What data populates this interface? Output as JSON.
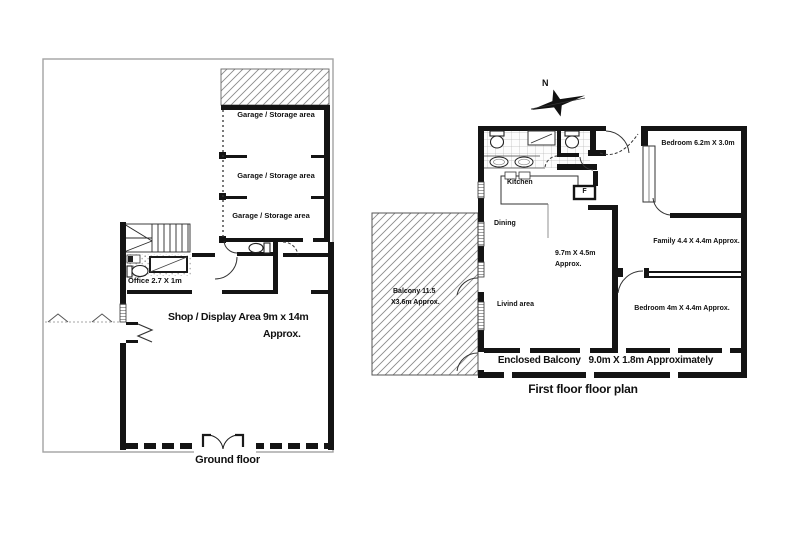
{
  "colors": {
    "ink": "#111111",
    "boundary": "#a3a3a3",
    "hatch": "#8a8a8a"
  },
  "ground_floor": {
    "caption": "Ground floor",
    "garage_labels": [
      "Garage / Storage area",
      "Garage / Storage area",
      "Garage / Storage area"
    ],
    "office_label": "Office 2.7 X 1m",
    "shop_area_label": "Shop / Display Area",
    "shop_area_size": "9m x 14m",
    "shop_area_approx": "Approx."
  },
  "first_floor": {
    "caption": "First floor floor plan",
    "compass_label": "N",
    "kitchen_label": "Kitchen",
    "dining_label": "Dining",
    "living_label": "Livind area",
    "living_size_line1": "9.7m X 4.5m",
    "living_size_line2": "Approx.",
    "fridge_label": "F",
    "bedroom_top_label": "Bedroom 6.2m X 3.0m",
    "family_label": "Family 4.4 X 4.4m Approx.",
    "bedroom_bottom_label": "Bedroom 4m X 4.4m Approx.",
    "enclosed_balcony_label": "Enclosed Balcony   9.0m X 1.8m Approximately",
    "balcony_label_line1": "Balcony 11.5",
    "balcony_label_line2": "X3.6m Approx."
  }
}
